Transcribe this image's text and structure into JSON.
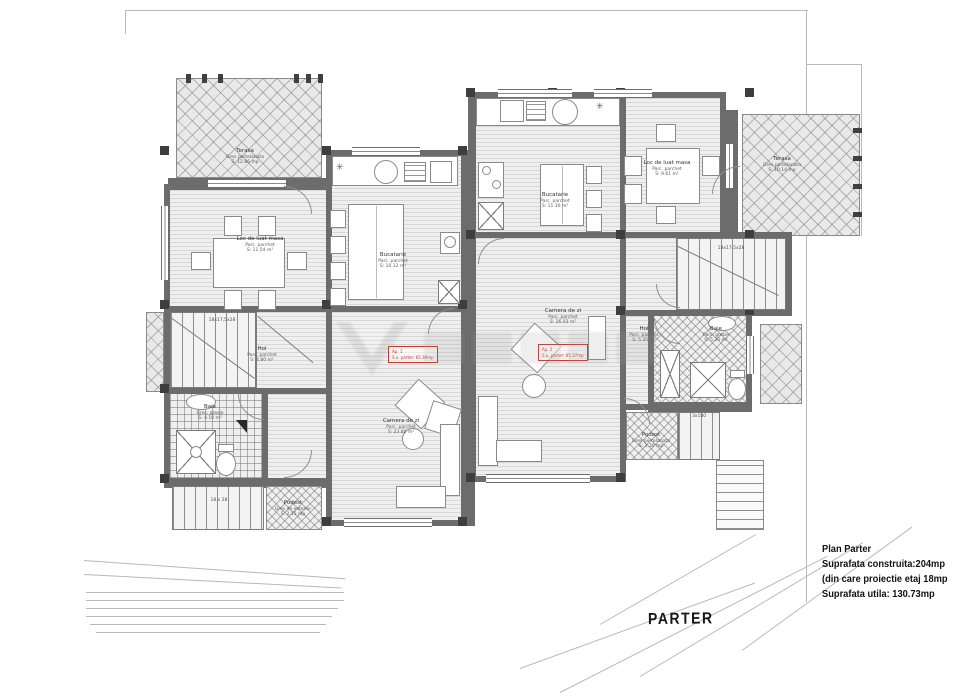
{
  "title_label": "PARTER",
  "info_block": {
    "line1": "Plan Parter",
    "line2": "Suprafata construita:204mp",
    "line3": "(din care proiectie etaj 18mp",
    "line4": "Suprafata utila: 130.73mp"
  },
  "rooms": {
    "terasa_left": {
      "name": "Terasa",
      "finish": "Gres portelanata",
      "area": "S: 12.86 mp"
    },
    "dining_left": {
      "name": "Loc de luat masa",
      "finish": "Parc. parchet",
      "area": "S: 11.54 m²"
    },
    "kitchen_left": {
      "name": "Bucatarie",
      "finish": "Parc. parchet",
      "area": "S: 10.12 m²"
    },
    "living_left": {
      "name": "Camera de zi",
      "finish": "Parc. parchet",
      "area": "S: 23.80 m²"
    },
    "hall_left": {
      "name": "Hol",
      "finish": "Parc. parchet",
      "area": "S: 4.80 m²"
    },
    "bath_left": {
      "name": "Baie",
      "finish": "Gres. gresie",
      "area": "S: 4.10 m²"
    },
    "podest_left": {
      "name": "Podest",
      "finish": "Gres de exterior",
      "area": "S: 2.15 mp"
    },
    "kitchen_right": {
      "name": "Bucatarie",
      "finish": "Parc. parchet",
      "area": "S: 11.30 m²"
    },
    "dining_right": {
      "name": "Loc de luat masa",
      "finish": "Parc. parchet",
      "area": "S: 9.61 m²"
    },
    "terasa_right": {
      "name": "Terasa",
      "finish": "Gres portelanata",
      "area": "S: 10.14 mp"
    },
    "living_right": {
      "name": "Camera de zi",
      "finish": "Parc. parchet",
      "area": "S: 26.03 m²"
    },
    "hall_right": {
      "name": "Hol",
      "finish": "Parc. parchet",
      "area": "S: 5.35 m²"
    },
    "bath_right": {
      "name": "Baie",
      "finish": "Parc. gresie",
      "area": "S: 5.20 m²"
    },
    "podest_right": {
      "name": "Podest",
      "finish": "Gres portelanata",
      "area": "S: 2.30 mp"
    }
  },
  "annotations": {
    "red_left": {
      "line1": "Ap. 1",
      "line2": "S.u. parter: 65.36mp"
    },
    "red_right": {
      "line1": "Ap. 2",
      "line2": "S.u. parter: 65.37mp"
    },
    "stair_dim_left": "18x17,5x28",
    "stair_dim_right": "18x17,5x28",
    "steps_left_dim": "18 x 28",
    "podest_steps_dim": "3x180"
  },
  "icons": {
    "watermark": "builder-logo-triangle-wordmark",
    "fixture_star": "✳"
  },
  "colors": {
    "wall": "#6c6c6c",
    "column": "#3e3e3e",
    "annotation_red": "#c0392b",
    "floor": "#efefef"
  }
}
